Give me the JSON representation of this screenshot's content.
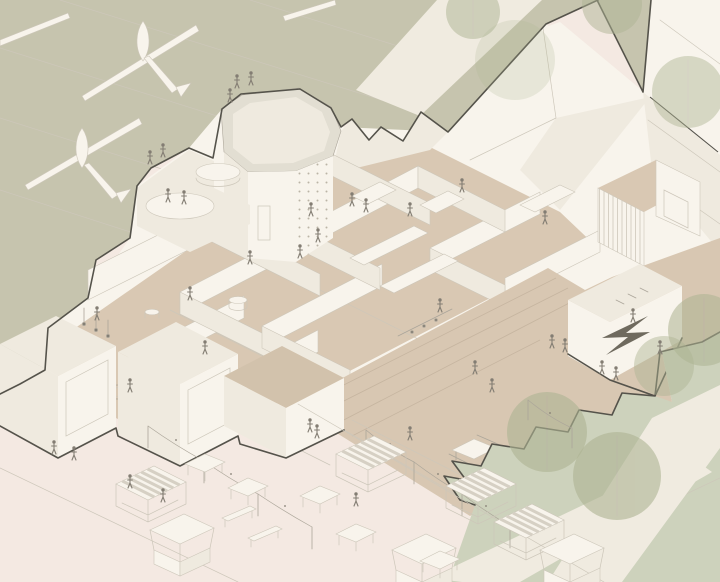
{
  "scene": {
    "title": "Axonometric cutaway drawing of a community building with an octagonal climbing tower, roof terraces, open-plan interior rooms, a stepped plaza and a street market with striped stalls and string lights",
    "medium": "architectural line illustration",
    "palette": {
      "grass": "#c6c4ae",
      "grassLight": "#cdd2bc",
      "tree": "#aeb493",
      "path": "#f0ebe0",
      "ground": "#f4e9e2",
      "plaza": "#d8c7b2",
      "floor": "#d9c8b3",
      "white": "#f8f4ec",
      "whiteShade": "#efeadf",
      "wallSide": "#e3ded2",
      "parapet": "#e2ded2",
      "outline": "#55534b",
      "line": "#aca69a",
      "lineLight": "#cdc7ba",
      "figure": "#837d73",
      "mural": "#6f6a5e",
      "tanRoof": "#d2c2ac",
      "stepLine": "#c6b5a0",
      "awningStripe": "#d6d0c4"
    },
    "landscape": {
      "grass_field": "upper lawn with kinetic sculptures and expansion joints",
      "sculptures": 2,
      "trees": 8,
      "paths": 3,
      "lower_lawn": "rounded trees beside crossing footpaths"
    },
    "building": {
      "label": "cutaway community building",
      "climbing_tower": {
        "label": "octagonal climbing tower",
        "climbers": 2
      },
      "roof_terrace": {
        "label": "roof terrace with round deck and seats",
        "visitors": 7
      },
      "interior": {
        "label": "open-plan rooms on tan floors",
        "rooms": 9,
        "occupants": 11
      },
      "kiosk": {
        "label": "plaza kiosk",
        "mural": "arrow mural"
      }
    },
    "plaza": {
      "label": "stepped plaza",
      "picnic_tables": 2,
      "walkers": 7
    },
    "market": {
      "label": "street market",
      "striped_stalls": 4,
      "counter_stalls": 3,
      "tables": 5,
      "benches": 2,
      "light_poles": 10,
      "string_light_runs": 3,
      "visitors": 6
    },
    "people_total": 36
  }
}
